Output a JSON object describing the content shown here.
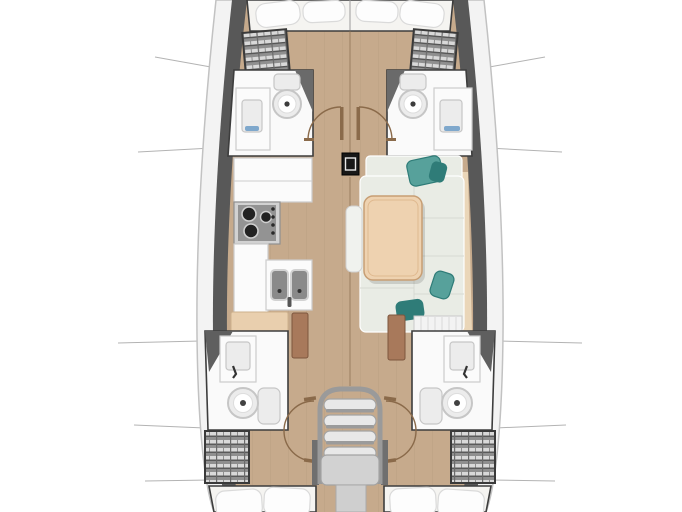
{
  "meta": {
    "title": "Sailboat interior layout plan (top view)",
    "diagram_type": "yacht-floor-plan",
    "orientation": "bow-up"
  },
  "areas": {
    "forward_cabin": "Forward cabin - V-berth",
    "forward_head_port": "Forward head (port) - toilet and washbasin",
    "forward_head_starboard": "Forward head (starboard) - toilet and washbasin",
    "galley": "Galley - stove, double sink, counters",
    "salon": "Salon - U-shaped settee with table",
    "aft_head_port": "Aft head (port) - shower, washbasin, toilet",
    "aft_head_starboard": "Aft head (starboard) - shower, washbasin, toilet",
    "aft_cabin_port": "Aft cabin (port) - double berth",
    "aft_cabin_starboard": "Aft cabin (starboard) - double berth",
    "companionway": "Companionway steps over engine compartment",
    "mast": "Mast compression post",
    "corridor": "Central passageway"
  },
  "fixtures": [
    "v-berth-pillows",
    "hanging-shelf-locker",
    "toilet",
    "washbasin",
    "shower-screen",
    "three-burner-stove",
    "double-sink",
    "galley-counter",
    "dining-table",
    "bench-seat",
    "settee-cushions",
    "teal-throw-pillows",
    "wardrobe-shelves",
    "open-cabin-door",
    "door-swing-arc",
    "companionway-steps",
    "engine-box",
    "hull-section-lines",
    "aft-berth-pillows"
  ],
  "palette": {
    "bg": "#ffffff",
    "hull_outline": "#c2c2c2",
    "hull_band": "#f3f3f3",
    "bulwark": "#585858",
    "wall_dark": "#3d3d3d",
    "floor_wood": "#c6aa8c",
    "plank_line": "#8a7152",
    "white_floor": "#fafafa",
    "counter": "#fbfbfb",
    "counter_edge": "#cccccc",
    "fixture_fill": "#ececec",
    "fixture_edge": "#c6c6c6",
    "steel": "#d2d2d2",
    "steel_dark": "#8f8f8f",
    "stove_panel": "#939393",
    "burner": "#222222",
    "basin": "#8a8a8a",
    "cushion": "#e9ece5",
    "cushion_edge": "#ffffff",
    "backrest": "#ead6b8",
    "table_wood": "#eed2b0",
    "table_edge": "#c79e74",
    "teal": "#57a19b",
    "teal_dark": "#2f7c78",
    "door_wood": "#a8795b",
    "arc_brown": "#8a6a4a",
    "bed_white": "#f5f4f1",
    "pillow": "#fdfdfd",
    "pillow_edge": "#dadada",
    "shelf_frame": "#3a3a3a",
    "step_fill": "#e8e8e8",
    "step_edge": "#a3a3a3",
    "engine_fill": "#d2d2d2",
    "section_line": "#b3b3b3",
    "mast_black": "#181818",
    "peach": "#e9cfae",
    "blue_accent": "#7fa8cc"
  }
}
